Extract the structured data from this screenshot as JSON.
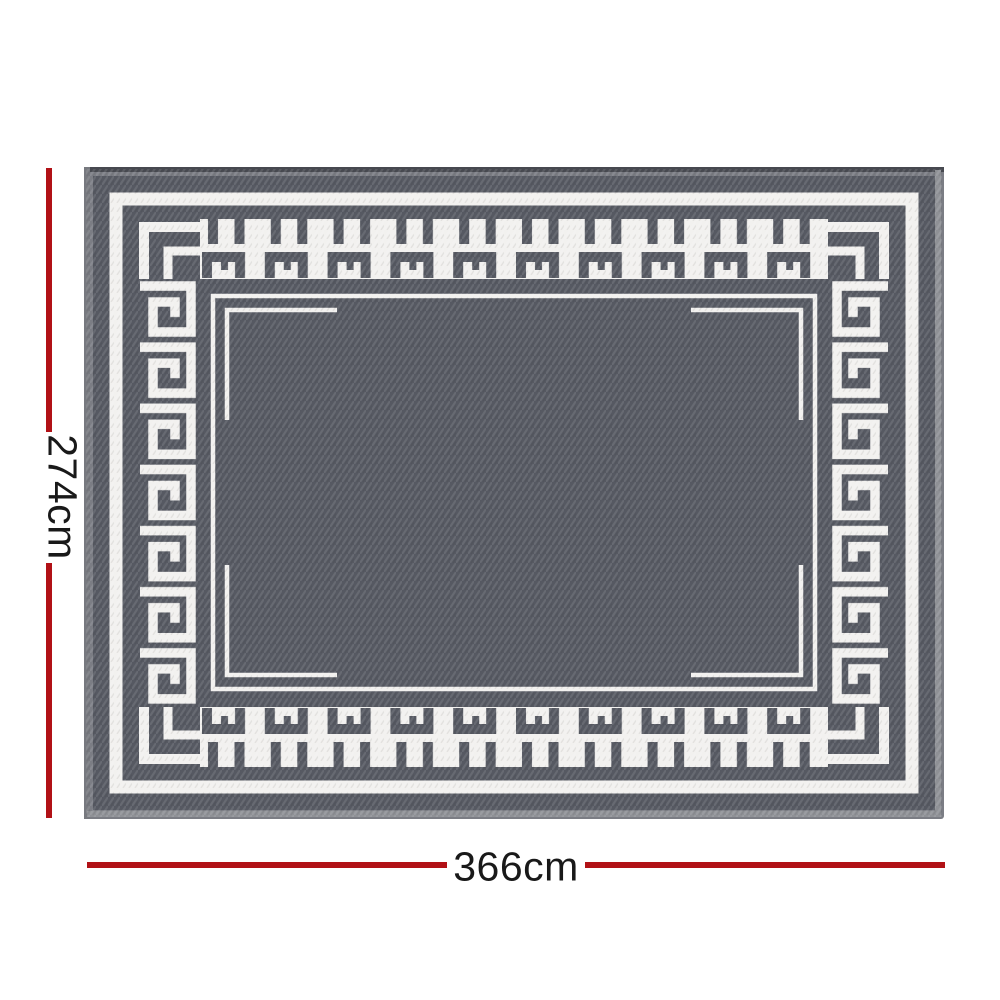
{
  "figure": {
    "title": "outdoor rug with greek key border and dimension annotations",
    "rug": {
      "pattern_name": "greek-key-meander-border",
      "field_color": "#565962",
      "pattern_color": "#f2f1ef",
      "edge_color": "#7b7d84",
      "edge_highlight_color": "#8f9196",
      "edge_shadow_color": "#474950"
    },
    "dimensions": {
      "height": {
        "label": "274cm"
      },
      "width": {
        "label": "366cm"
      },
      "line_color": "#b11116",
      "label_color": "#191919"
    }
  }
}
